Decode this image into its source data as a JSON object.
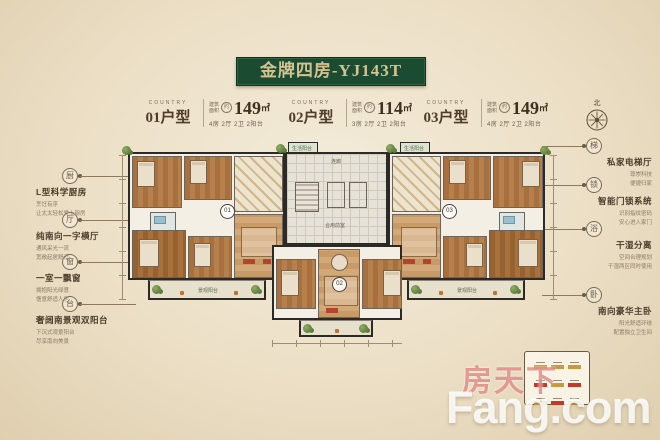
{
  "title": {
    "text": "金牌四房-YJ143T"
  },
  "units": [
    {
      "country": "COUNTRY",
      "name": "01户型",
      "area_prefix_top": "建筑",
      "area_prefix_bottom": "面积",
      "approx": "约",
      "area": "149",
      "area_unit": "㎡",
      "spec": "4房 2厅 2卫 2阳台",
      "plan_tag": "01"
    },
    {
      "country": "COUNTRY",
      "name": "02户型",
      "area_prefix_top": "建筑",
      "area_prefix_bottom": "面积",
      "approx": "约",
      "area": "114",
      "area_unit": "㎡",
      "spec": "3房 2厅 2卫 2阳台",
      "plan_tag": "02"
    },
    {
      "country": "COUNTRY",
      "name": "03户型",
      "area_prefix_top": "建筑",
      "area_prefix_bottom": "面积",
      "approx": "约",
      "area": "149",
      "area_unit": "㎡",
      "spec": "4房 2厅 2卫 2阳台",
      "plan_tag": "03"
    }
  ],
  "compass": {
    "label": "北"
  },
  "features_left": [
    {
      "icon": "厨",
      "name": "L型科学厨房",
      "lines": [
        "烹饪有序",
        "让太太轻松爱上厨房"
      ]
    },
    {
      "icon": "厅",
      "name": "纯南向一字横厅",
      "lines": [
        "通风采光一流",
        "宽敞起居舒适"
      ]
    },
    {
      "icon": "窗",
      "name": "一室一飘窗",
      "lines": [
        "拥抱阳光绿意",
        "惬意舒适人居"
      ]
    },
    {
      "icon": "台",
      "name": "奢阔南景观双阳台",
      "lines": [
        "下沉式观景阳台",
        "尽享南向美景"
      ]
    }
  ],
  "features_right": [
    {
      "icon": "梯",
      "name": "私家电梯厅",
      "lines": [
        "尊崇科技",
        "便捷归家"
      ]
    },
    {
      "icon": "锁",
      "name": "智能门锁系统",
      "lines": [
        "识别指纹密码",
        "安心进入家门"
      ]
    },
    {
      "icon": "浴",
      "name": "干湿分离",
      "lines": [
        "空间合理规划",
        "干湿两区同时使用"
      ]
    },
    {
      "icon": "卧",
      "name": "南向豪华主卧",
      "lines": [
        "阳光舒适环绕",
        "配置独立卫生间"
      ]
    }
  ],
  "plan": {
    "labels": {
      "life_balcony": "生活阳台",
      "view_balcony": "景观阳台",
      "shared_lobby": "合用前室",
      "corridor": "连廊"
    }
  },
  "legend": {
    "swatches": [
      "#c89a3f",
      "#c89a3f",
      "#c89a3f",
      "#c0392b",
      "#c89a3f",
      "#c0392b",
      "#c89a3f",
      "#c0392b",
      "#c89a3f"
    ]
  },
  "watermark": {
    "cn": "房天下",
    "en": "Fang.com"
  },
  "colors": {
    "banner_green": "#1b4c31",
    "banner_text": "#d6c290",
    "accent_red": "#c0392b",
    "wood": "#a8703e",
    "plant_green": "#5c7a3e"
  }
}
